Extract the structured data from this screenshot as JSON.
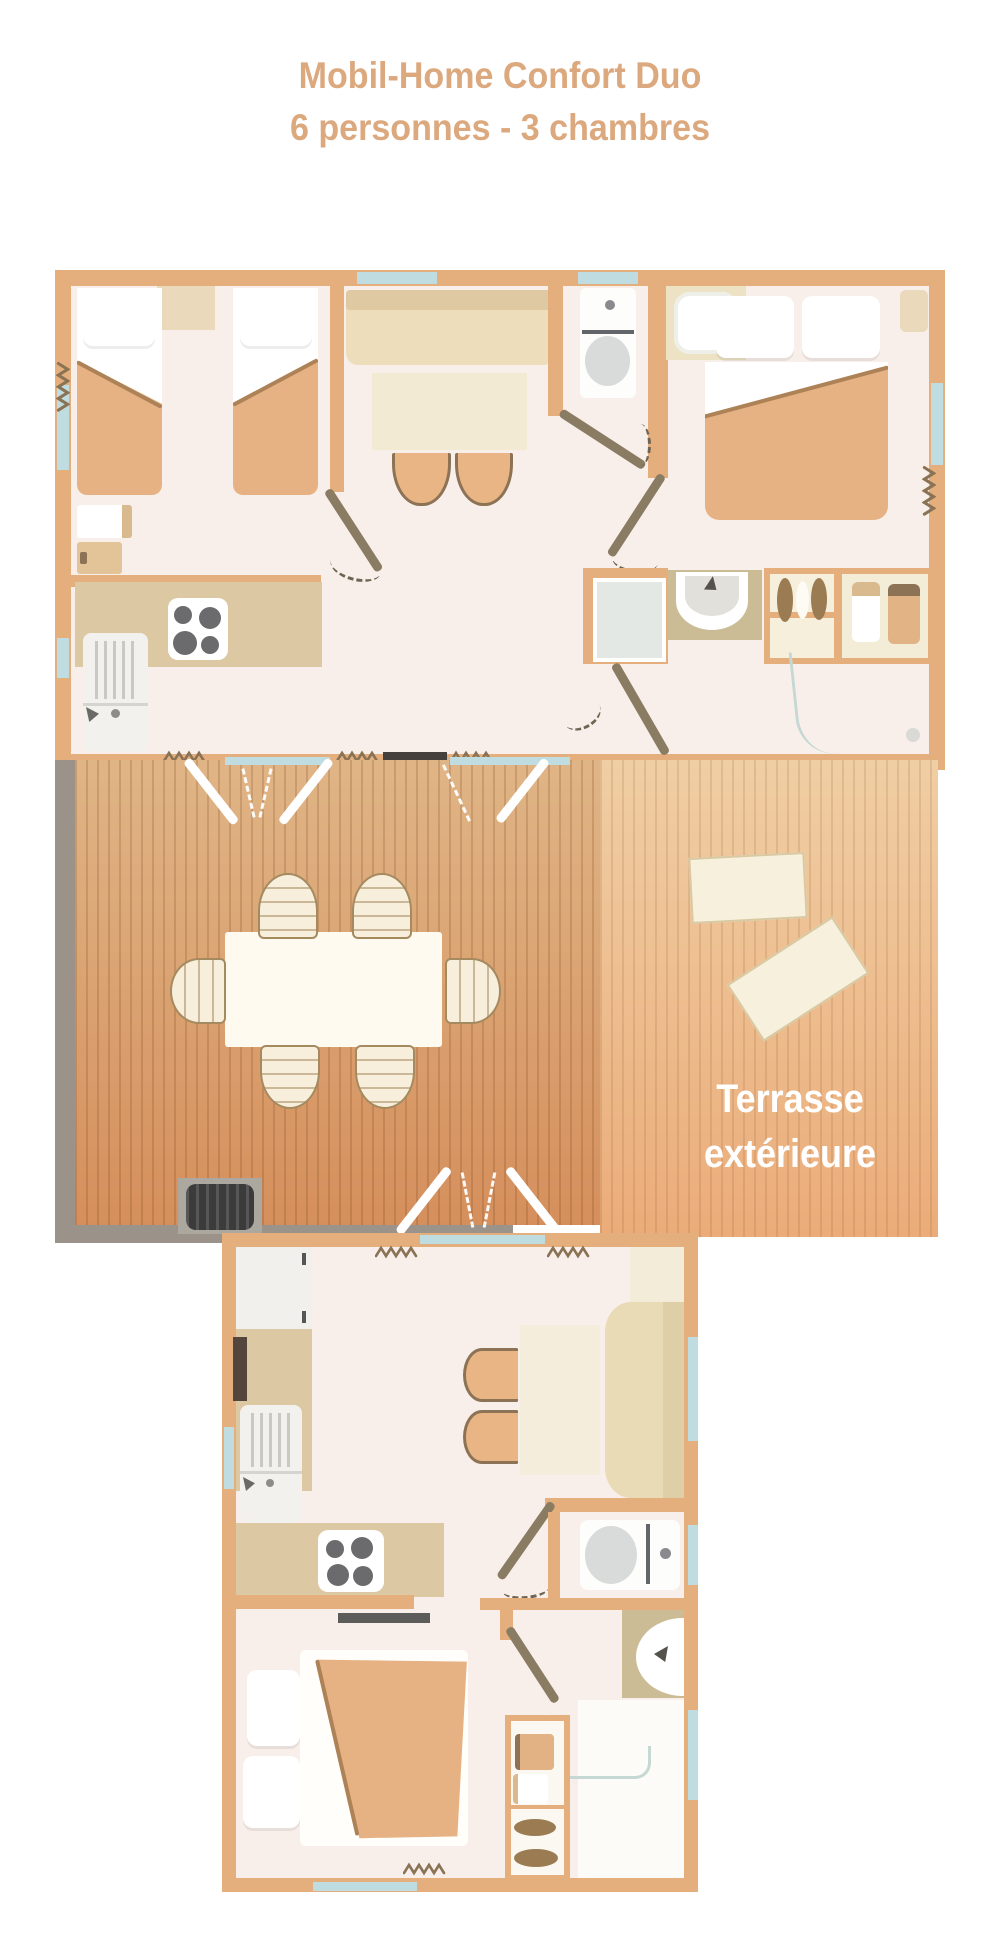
{
  "title": {
    "line1": "Mobil-Home Confort Duo",
    "line2": "6 personnes - 3 chambres"
  },
  "terrace": {
    "label_line1": "Terrasse",
    "label_line2": "extérieure"
  },
  "palette": {
    "title_color": "#DCA87E",
    "terrace_text_color": "#FFFFFF",
    "wall": "#E5AF7D",
    "window": "#BFDCE0",
    "floor": "#F9EFEA",
    "deck_left_top": "#E0B586",
    "deck_left_bottom": "#D58F5C",
    "deck_right_top": "#F0CEA4",
    "deck_right_bottom": "#EBAC79",
    "blanket_tan": "#E6B283",
    "sofa_beige": "#EDDDBB",
    "sofa_beige_dark": "#DFC9A2",
    "table_cream": "#F3EAD3",
    "counter_tan": "#DCC8A2",
    "bath_khaki": "#CBBC96",
    "door_leaf": "#8A7B63",
    "dash": "#6F6352",
    "gray_border": "#9B938A",
    "bbq_dark": "#3B3B3B",
    "threshold_dark": "#46403C",
    "stool_tan": "#E9B585",
    "stool_outline": "#8D7355",
    "zigzag": "#8A7355",
    "nightstand": "#EAD9BA",
    "shower_gray": "#E4E8E5",
    "glass_line": "#C6D8D4"
  }
}
